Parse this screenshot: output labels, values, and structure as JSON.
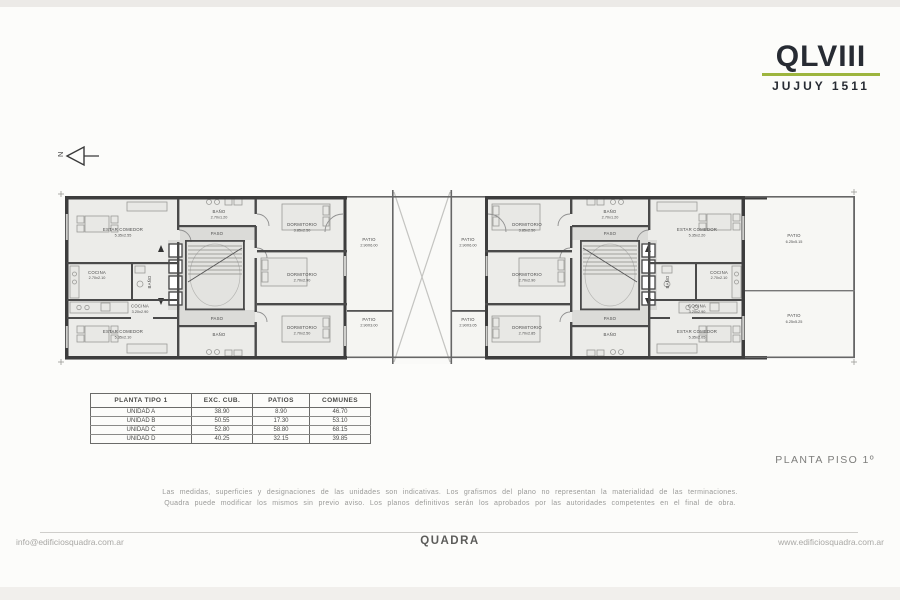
{
  "logo": {
    "name": "QLVIII",
    "subtitle": "JUJUY 1511",
    "accent_color": "#9db53e"
  },
  "plan": {
    "title": "PLANTA PISO 1º",
    "north_label": "N",
    "left_unit": {
      "estar_top": {
        "name": "ESTAR COMEDOR",
        "dims": "5.35x2.55"
      },
      "cocina_top": {
        "name": "COCINA",
        "dims": "2.70x2.10"
      },
      "banio_side": {
        "name": "BAÑO"
      },
      "cocina_strip": {
        "name": "COCINA",
        "dims": "3.20x2.90"
      },
      "estar_bottom": {
        "name": "ESTAR COMEDOR",
        "dims": "5.35x2.10"
      },
      "banio_top": {
        "name": "BAÑO",
        "dims": "2.70x1.20"
      },
      "paso_top": {
        "name": "PASO"
      },
      "paso_bottom": {
        "name": "PASO"
      },
      "banio_bottom": {
        "name": "BAÑO"
      },
      "dorm1": {
        "name": "DORMITORIO",
        "dims": "3.85x2.50"
      },
      "dorm2": {
        "name": "DORMITORIO",
        "dims": "2.70x2.90"
      },
      "dorm3": {
        "name": "DORMITORIO",
        "dims": "2.70x2.50"
      }
    },
    "center_patios": {
      "top_left": {
        "name": "PATIO",
        "dims": "2.90X6.00"
      },
      "top_right": {
        "name": "PATIO",
        "dims": "2.90X6.00"
      },
      "bottom_left": {
        "name": "PATIO",
        "dims": "2.90X3.00"
      },
      "bottom_right": {
        "name": "PATIO",
        "dims": "2.90X3.05"
      }
    },
    "right_unit": {
      "dorm1": {
        "name": "DORMITORIO",
        "dims": "3.85x2.50"
      },
      "dorm2": {
        "name": "DORMITORIO",
        "dims": "2.70x2.90"
      },
      "dorm3": {
        "name": "DORMITORIO",
        "dims": "2.70x2.85"
      },
      "banio_top": {
        "name": "BAÑO",
        "dims": "2.70x1.20"
      },
      "paso_top": {
        "name": "PASO"
      },
      "paso_bottom": {
        "name": "PASO"
      },
      "banio_bottom": {
        "name": "BAÑO"
      },
      "estar_top": {
        "name": "ESTAR COMEDOR",
        "dims": "5.35x2.20"
      },
      "cocina_top": {
        "name": "COCINA",
        "dims": "2.70x2.10"
      },
      "banio_side": {
        "name": "BAÑO"
      },
      "cocina_strip": {
        "name": "COCINA",
        "dims": "3.20x2.90"
      },
      "estar_bottom": {
        "name": "ESTAR COMEDOR",
        "dims": "5.35x2.05"
      }
    },
    "right_patios": {
      "top": {
        "name": "PATIO",
        "dims": "6.25x5.15"
      },
      "bottom": {
        "name": "PATIO",
        "dims": "6.25x5.25"
      }
    }
  },
  "table": {
    "headers": [
      "PLANTA TIPO 1",
      "EXC. CUB.",
      "PATIOS",
      "COMUNES"
    ],
    "rows": [
      {
        "label": "UNIDAD A",
        "exc": "38.90",
        "patios": "8.90",
        "comunes": "46.70"
      },
      {
        "label": "UNIDAD B",
        "exc": "50.55",
        "patios": "17.30",
        "comunes": "53.10"
      },
      {
        "label": "UNIDAD C",
        "exc": "52.80",
        "patios": "58.80",
        "comunes": "68.15"
      },
      {
        "label": "UNIDAD D",
        "exc": "40.25",
        "patios": "32.15",
        "comunes": "39.85"
      }
    ]
  },
  "disclaimer": {
    "line1": "Las medidas, superficies y designaciones de las unidades son indicativas. Los grafismos del plano no representan la materialidad de las terminaciones.",
    "line2": "Quadra puede modificar los mismos sin previo aviso. Los planos definitivos serán los aprobados por las autoridades competentes en el final de obra."
  },
  "footer": {
    "email": "info@edificiosquadra.com.ar",
    "brand": "QUADRA",
    "website": "www.edificiosquadra.com.ar"
  }
}
